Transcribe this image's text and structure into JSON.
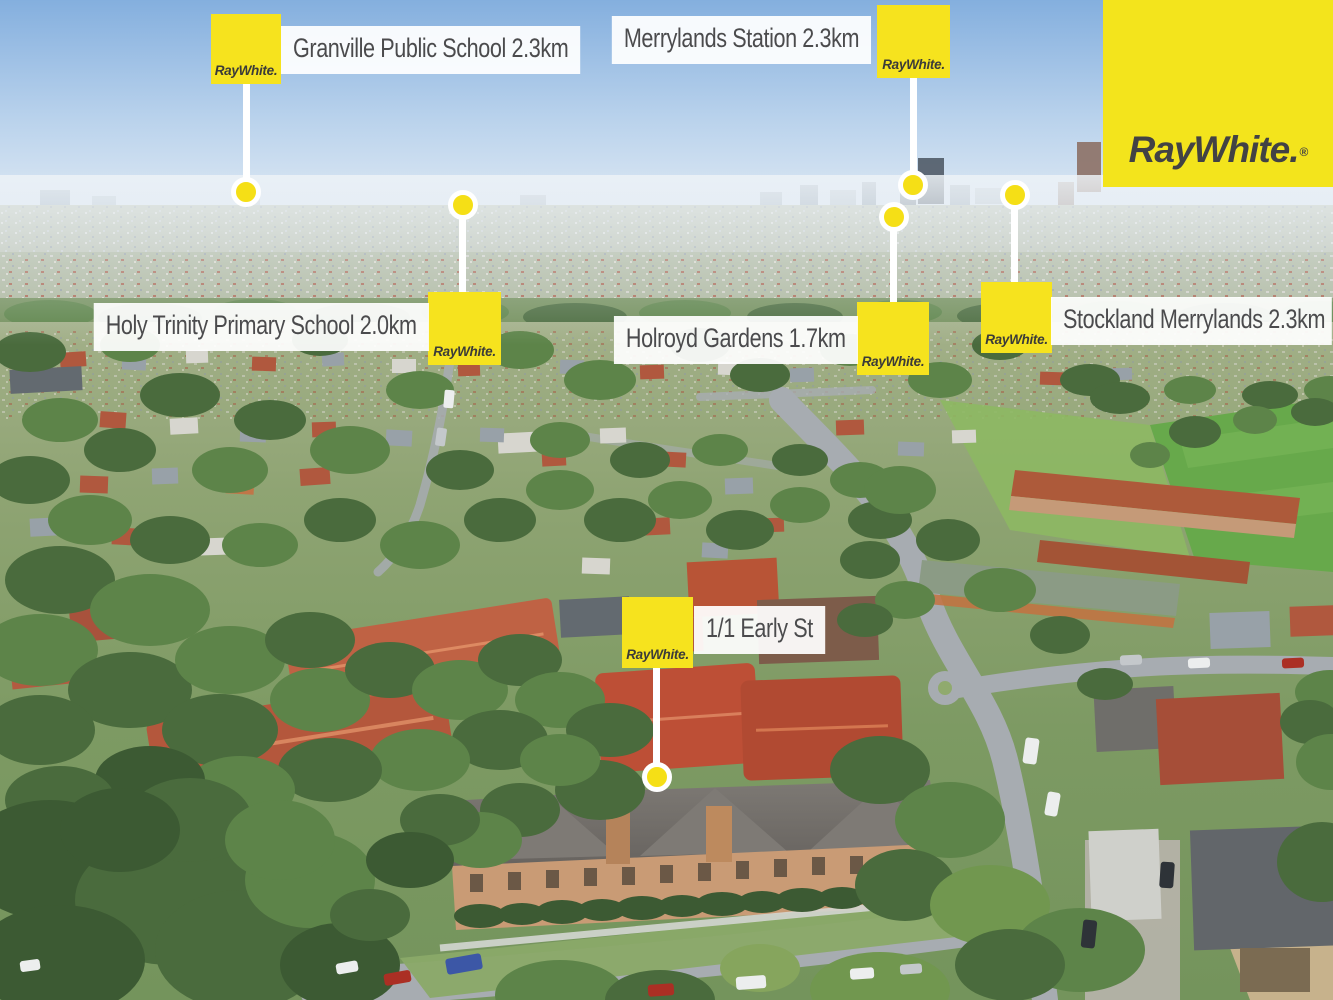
{
  "brand": {
    "name": "Ray White",
    "logo_text": "RayWhite.",
    "registered_mark": "®",
    "yellow": "#F6E31E",
    "logo_gray": "#424244",
    "label_text_color": "#4B4B4D",
    "label_background": "#FFFFFF"
  },
  "watermark": {
    "logo_text": "RayWhite.",
    "registered_mark": "®"
  },
  "property": {
    "address_label": "1/1 Early St"
  },
  "markers": [
    {
      "id": "granville-public-school",
      "label": "Granville Public School 2.3km",
      "place": "Granville Public School",
      "distance": "2.3km",
      "badge": "RayWhite."
    },
    {
      "id": "merrylands-station",
      "label": "Merrylands Station 2.3km",
      "place": "Merrylands Station",
      "distance": "2.3km",
      "badge": "RayWhite."
    },
    {
      "id": "holy-trinity-primary-school",
      "label": "Holy Trinity Primary School 2.0km",
      "place": "Holy Trinity Primary School",
      "distance": "2.0km",
      "badge": "RayWhite."
    },
    {
      "id": "holroyd-gardens",
      "label": "Holroyd Gardens 1.7km",
      "place": "Holroyd Gardens",
      "distance": "1.7km",
      "badge": "RayWhite."
    },
    {
      "id": "stockland-merrylands",
      "label": "Stockland Merrylands 2.3km",
      "place": "Stockland Merrylands",
      "distance": "2.3km",
      "badge": "RayWhite."
    },
    {
      "id": "subject-property",
      "label": "1/1 Early St",
      "place": "1/1 Early St",
      "distance": "",
      "badge": "RayWhite."
    }
  ]
}
